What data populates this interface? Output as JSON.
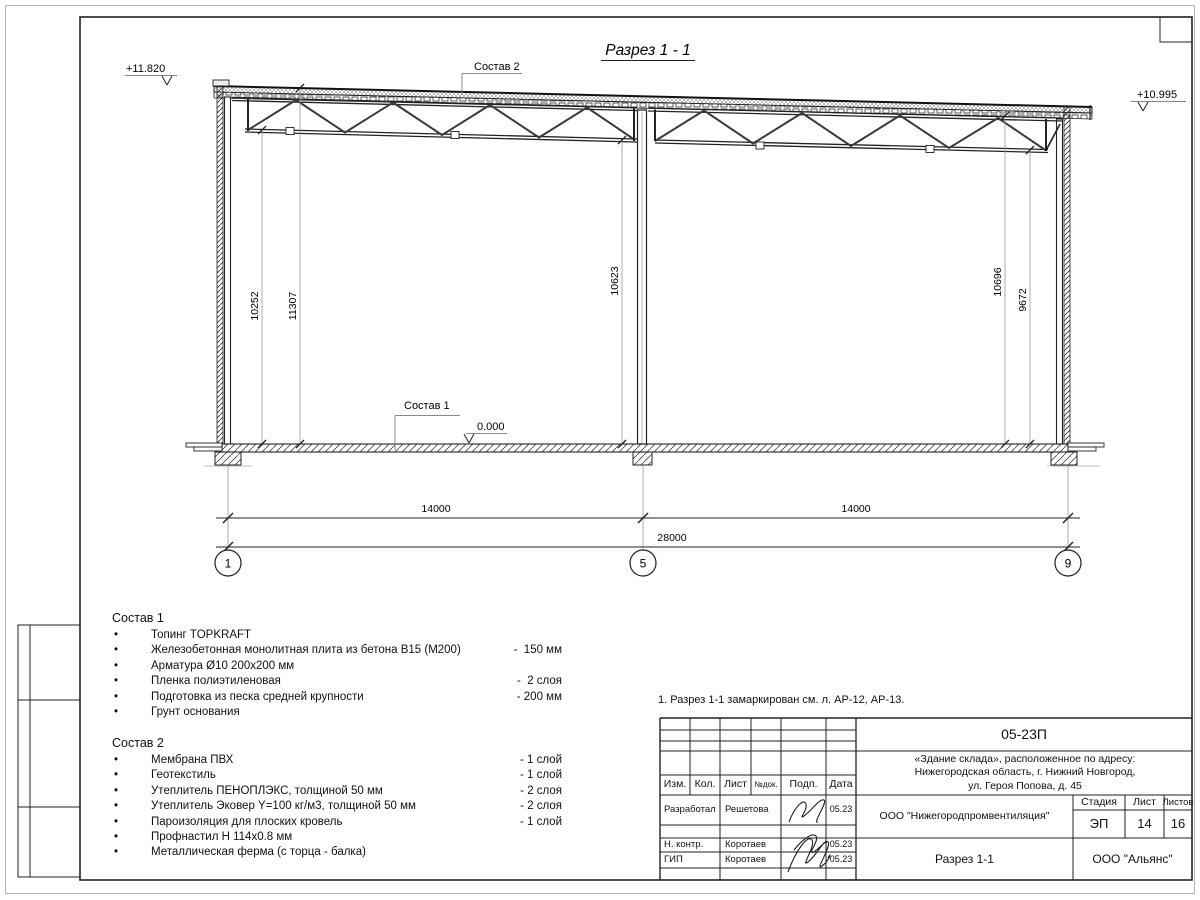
{
  "sheet": {
    "note": "1. Разрез 1-1 замаркирован см. л. АР-12, АР-13."
  },
  "drawing": {
    "title": "Разрез 1 - 1",
    "elev_left": "+11.820",
    "elev_right": "+10.995",
    "elev_zero": "0.000",
    "sostav1_label": "Состав 1",
    "sostav2_label": "Состав 2",
    "vdims": [
      "10252",
      "11307",
      "10623",
      "10696",
      "9672"
    ],
    "hdims": [
      "14000",
      "14000",
      "28000"
    ],
    "axes": [
      "1",
      "5",
      "9"
    ]
  },
  "sostav1": {
    "title": "Состав 1",
    "items": [
      {
        "text": "Топинг TOPKRAFT",
        "value": ""
      },
      {
        "text": "Железобетонная монолитная плита из бетона В15 (М200)",
        "value": "-  150 мм"
      },
      {
        "text": "Арматура Ø10 200х200 мм",
        "value": ""
      },
      {
        "text": "Пленка полиэтиленовая",
        "value": "-  2 слоя"
      },
      {
        "text": "Подготовка из песка средней крупности",
        "value": "- 200 мм"
      },
      {
        "text": "Грунт основания",
        "value": ""
      }
    ]
  },
  "sostav2": {
    "title": "Состав 2",
    "items": [
      {
        "text": "Мембрана ПВХ",
        "value": "- 1 слой"
      },
      {
        "text": "Геотекстиль",
        "value": "- 1 слой"
      },
      {
        "text": "Утеплитель ПЕНОПЛЭКС, толщиной 50 мм",
        "value": "- 2 слоя"
      },
      {
        "text": "Утеплитель Эковер Y=100 кг/м3, толщиной 50 мм",
        "value": "- 2 слоя"
      },
      {
        "text": "Пароизоляция для плоских кровель",
        "value": "- 1 слой"
      },
      {
        "text": "Профнастил Н 114х0.8 мм",
        "value": ""
      },
      {
        "text": "Металлическая ферма (с торца - балка)",
        "value": ""
      }
    ]
  },
  "stamp": {
    "code": "05-23П",
    "project_line1": "«Здание склада», расположенное по адресу:",
    "project_line2": "Нижегородская область, г. Нижний Новгород,",
    "project_line3": "ул. Героя Попова, д. 45",
    "cols": {
      "izm": "Изм.",
      "kol": "Кол.",
      "list": "Лист",
      "ndok": "№док.",
      "podp": "Подп.",
      "data": "Дата"
    },
    "rows": [
      {
        "role": "Разработал",
        "name": "Решетова",
        "date": "05.23"
      },
      {
        "role": "Н. контр.",
        "name": "Коротаев",
        "date": "05.23"
      },
      {
        "role": "ГИП",
        "name": "Коротаев",
        "date": "05.23"
      }
    ],
    "org": "ООО \"Нижегородпромвентиляция\"",
    "stage_label": "Стадия",
    "sheet_label": "Лист",
    "sheets_label": "Листов",
    "stage": "ЭП",
    "sheet_num": "14",
    "sheets_total": "16",
    "section_title": "Разрез 1-1",
    "org2": "ООО \"Альянс\""
  }
}
